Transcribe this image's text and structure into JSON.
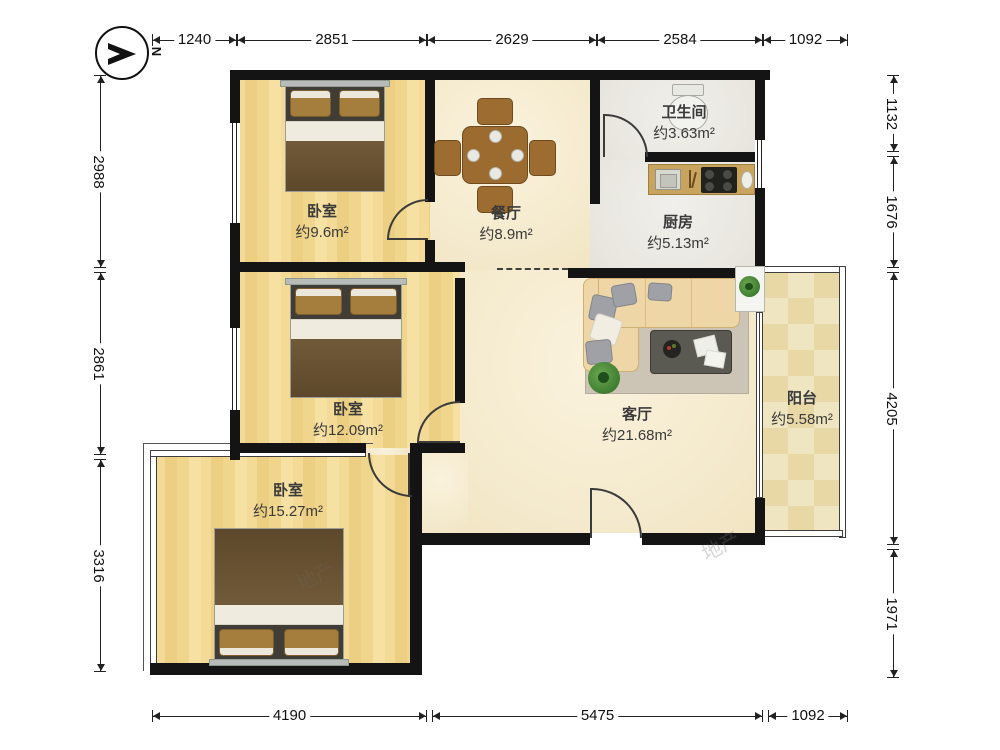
{
  "compass": {
    "label": "N"
  },
  "watermark": "地产",
  "rooms": [
    {
      "id": "bedroom-1",
      "name": "卧室",
      "area": "约9.6m²"
    },
    {
      "id": "dining",
      "name": "餐厅",
      "area": "约8.9m²"
    },
    {
      "id": "bathroom",
      "name": "卫生间",
      "area": "约3.63m²"
    },
    {
      "id": "kitchen",
      "name": "厨房",
      "area": "约5.13m²"
    },
    {
      "id": "bedroom-2",
      "name": "卧室",
      "area": "约12.09m²"
    },
    {
      "id": "living",
      "name": "客厅",
      "area": "约21.68m²"
    },
    {
      "id": "bedroom-3",
      "name": "卧室",
      "area": "约15.27m²"
    },
    {
      "id": "balcony",
      "name": "阳台",
      "area": "约5.58m²"
    }
  ],
  "dimensions": {
    "top": [
      "1240",
      "2851",
      "2629",
      "2584",
      "1092"
    ],
    "left": [
      "2988",
      "2861",
      "3316"
    ],
    "right": [
      "1132",
      "1676",
      "4205",
      "1971"
    ],
    "bottom": [
      "4190",
      "5475",
      "1092"
    ]
  }
}
